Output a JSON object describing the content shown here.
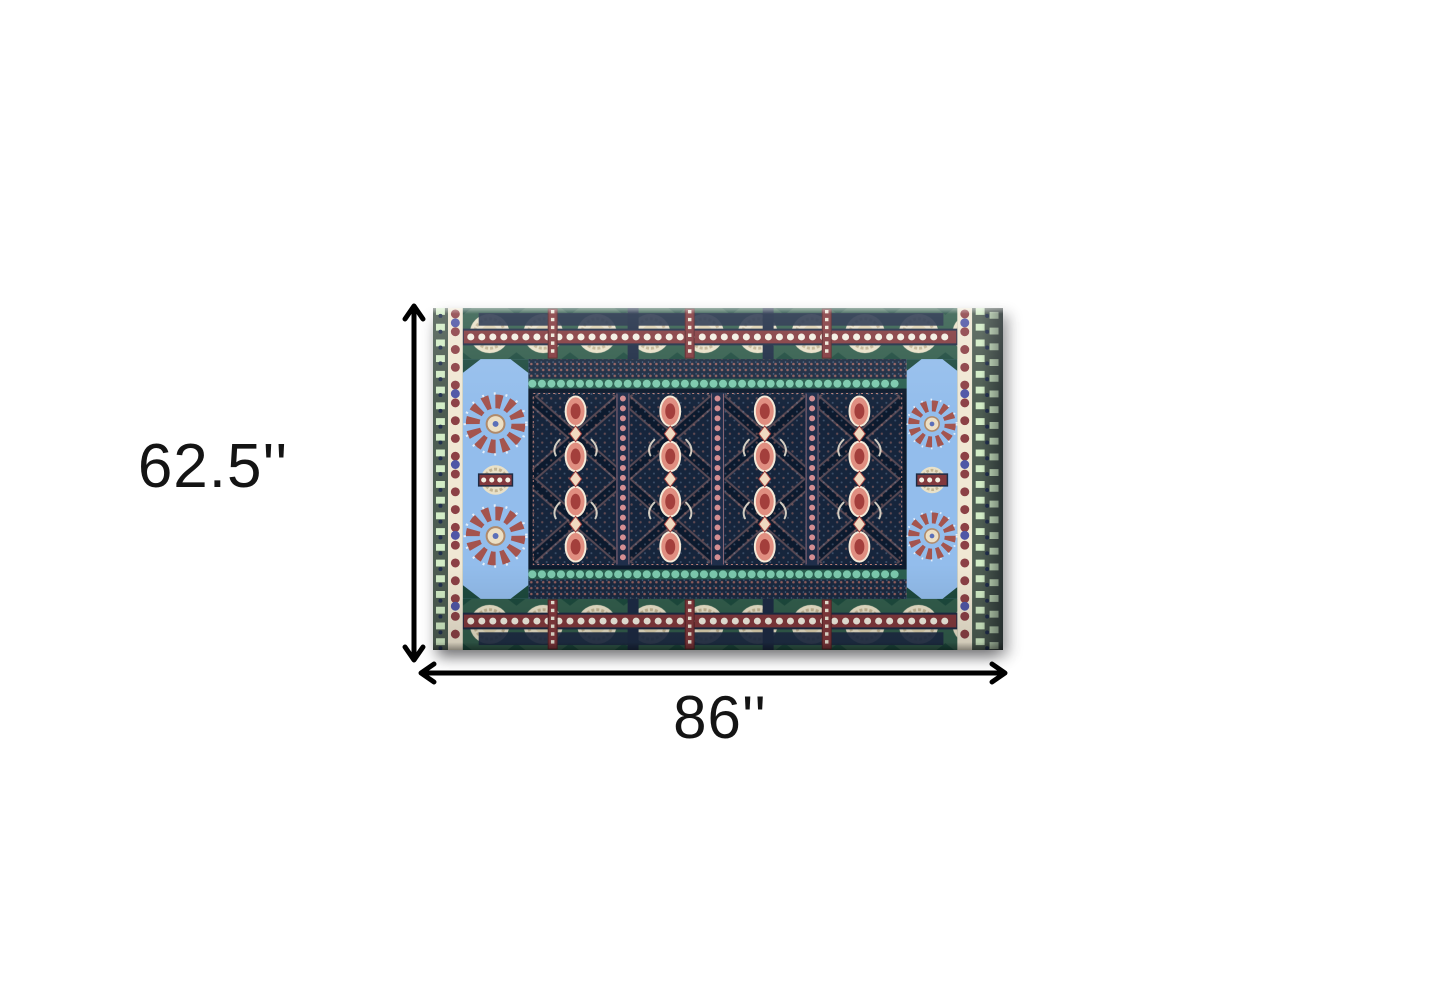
{
  "page": {
    "background_color": "#ffffff"
  },
  "diagram": {
    "type": "product-dimension-diagram",
    "height_label": "62.5''",
    "width_label": "86''",
    "height_value_inches": 62.5,
    "width_value_inches": 86,
    "arrow_color": "#000000",
    "label_color": "#141414"
  },
  "product_image": {
    "description": "Ornate bohemian area rug: dark navy center field with four columns of coral floral medallions in a diagonal lattice, light blue starburst side panels, cream rosette borders on dark green with maroon beaded bands, cream bead side strips and teal fringe bands",
    "palette": {
      "field_navy": "#16253c",
      "border_green": "#2e584a",
      "rosette_cream": "#e9e1c8",
      "medallion_coral": "#e08e80",
      "medallion_red": "#a33f3c",
      "panel_blue": "#93bdec",
      "bead_maroon": "#82393d",
      "bead_blue": "#4f57a6",
      "fringe_teal": "#7cc9ad",
      "leaf_green": "#d2ecc6"
    }
  }
}
